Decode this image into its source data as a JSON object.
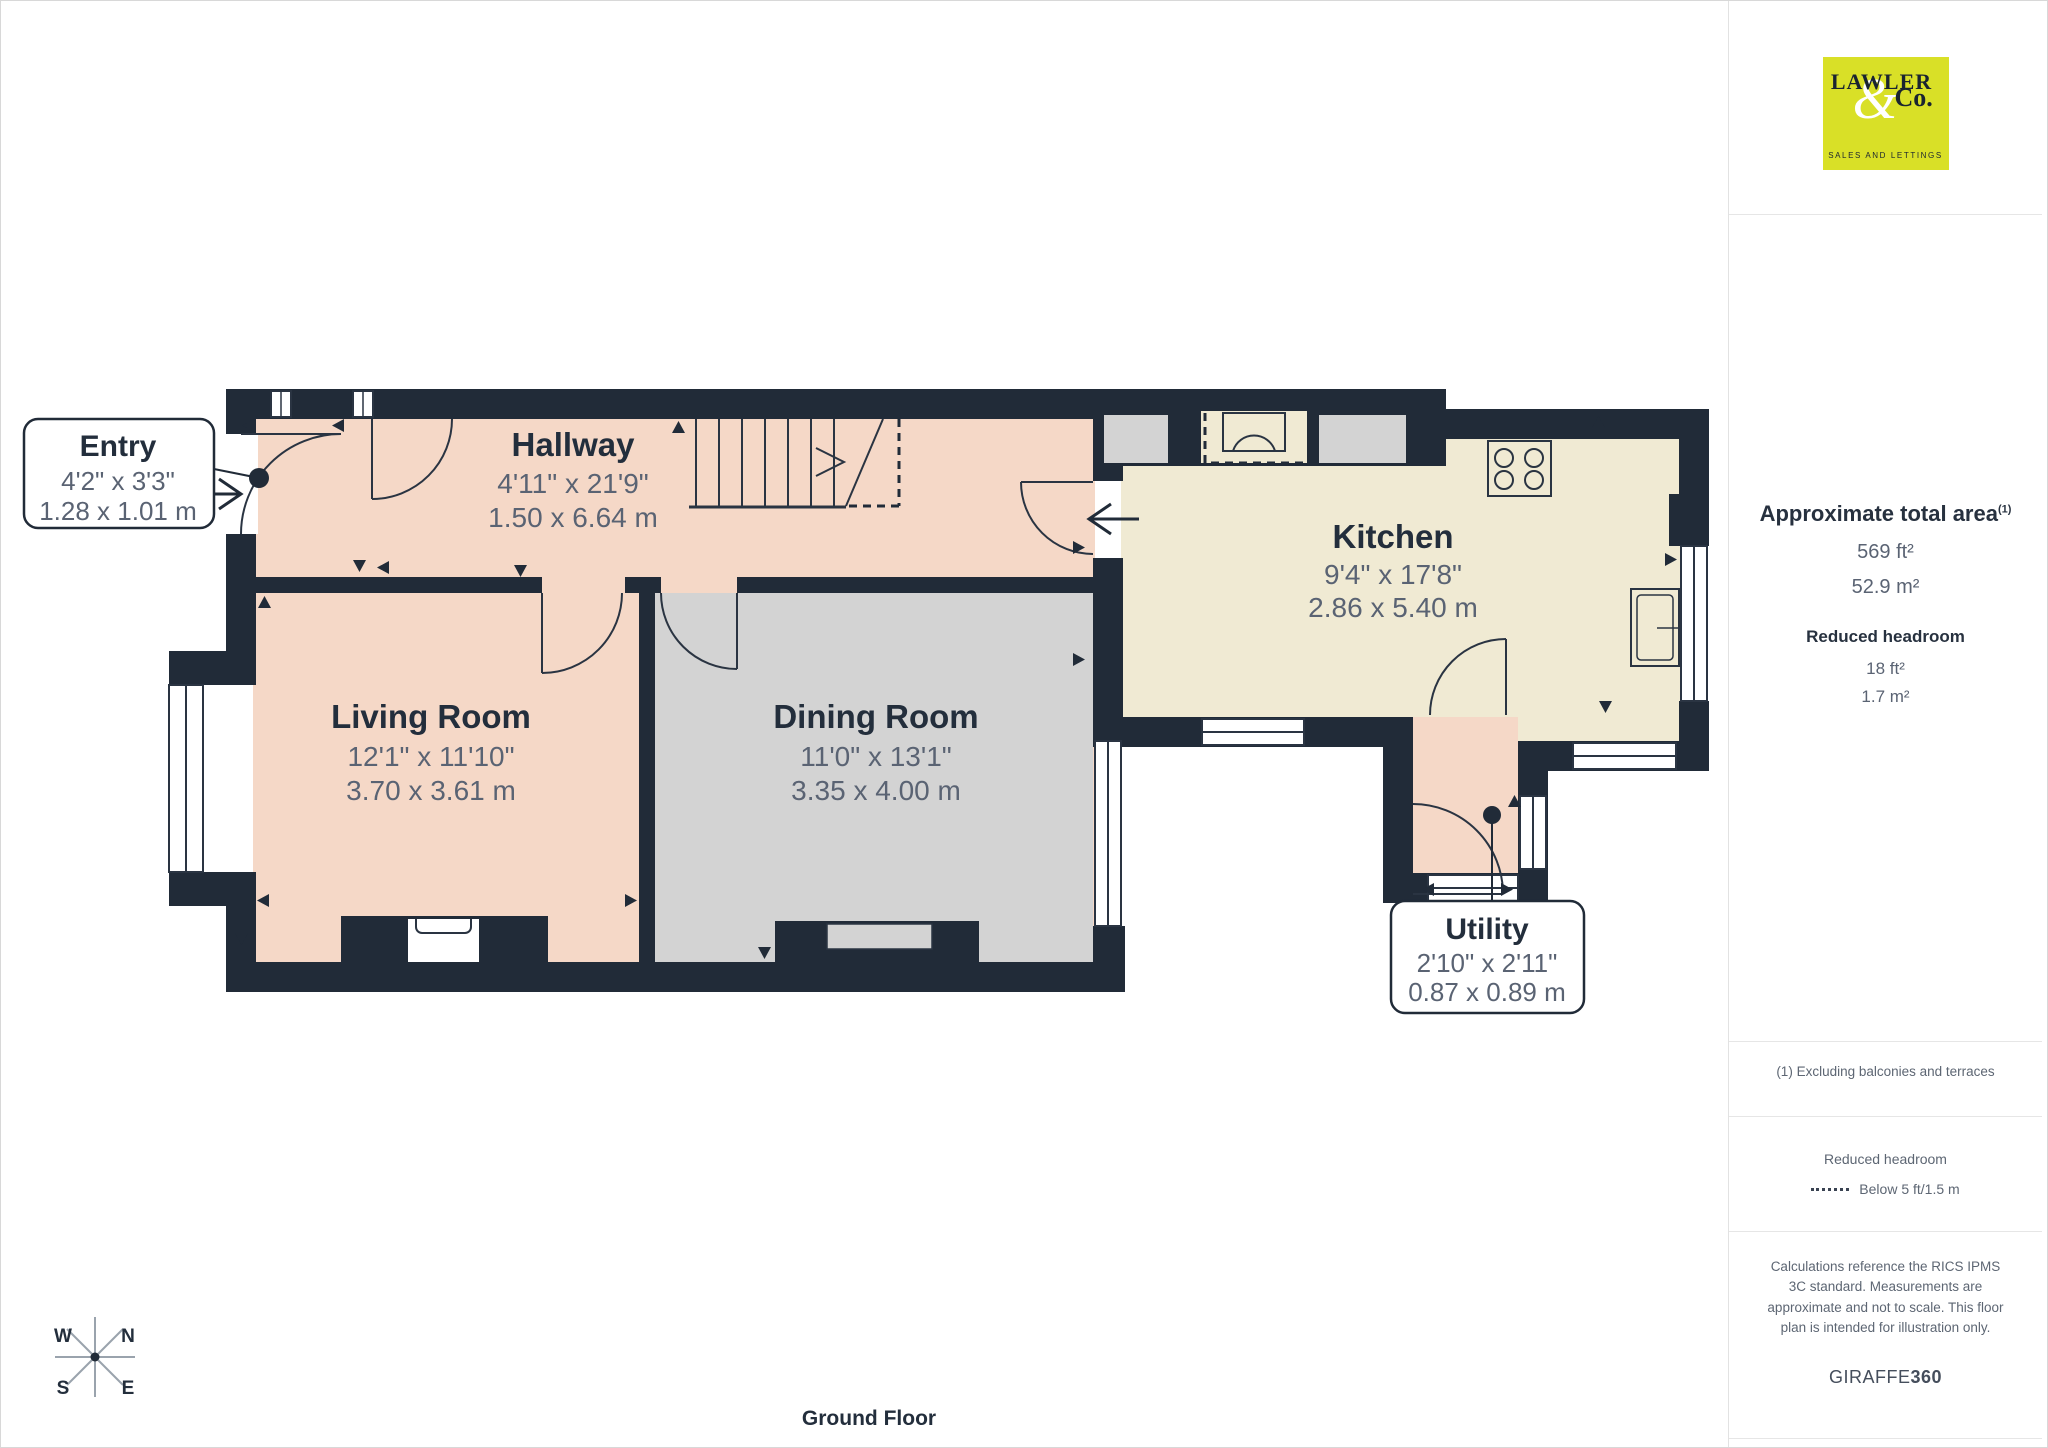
{
  "floor_plan": {
    "title": "Ground Floor",
    "rooms": [
      {
        "name": "Entry",
        "imperial": "4'2\" x 3'3\"",
        "metric": "1.28 x 1.01 m"
      },
      {
        "name": "Hallway",
        "imperial": "4'11\" x 21'9\"",
        "metric": "1.50 x 6.64 m"
      },
      {
        "name": "Living Room",
        "imperial": "12'1\" x 11'10\"",
        "metric": "3.70 x 3.61 m"
      },
      {
        "name": "Dining Room",
        "imperial": "11'0\" x 13'1\"",
        "metric": "3.35 x 4.00 m"
      },
      {
        "name": "Kitchen",
        "imperial": "9'4\" x 17'8\"",
        "metric": "2.86 x 5.40 m"
      },
      {
        "name": "Utility",
        "imperial": "2'10\" x 2'11\"",
        "metric": "0.87 x 0.89 m"
      }
    ],
    "compass": {
      "w": "W",
      "n": "N",
      "s": "S",
      "e": "E"
    },
    "colors": {
      "wall": "#212b38",
      "floor_peach": "#f5d8c7",
      "floor_gray": "#d3d3d3",
      "floor_cream": "#f0ead3"
    }
  },
  "sidebar": {
    "logo": {
      "line1": "LAWLER",
      "amp": "&",
      "co": "Co.",
      "tagline": "SALES AND LETTINGS",
      "bg_color": "#d9e027"
    },
    "area": {
      "heading": "Approximate total area",
      "superscript": "(1)",
      "imperial": "569 ft²",
      "metric": "52.9 m²"
    },
    "reduced_headroom": {
      "heading": "Reduced headroom",
      "imperial": "18 ft²",
      "metric": "1.7 m²"
    },
    "note": "(1) Excluding balconies and terraces",
    "legend": {
      "heading": "Reduced headroom",
      "label": "Below 5 ft/1.5 m"
    },
    "disclaimer": "Calculations reference the RICS IPMS 3C standard. Measurements are approximate and not to scale. This floor plan is intended for illustration only.",
    "brand": {
      "name": "GIRAFFE",
      "suffix": "360"
    }
  }
}
